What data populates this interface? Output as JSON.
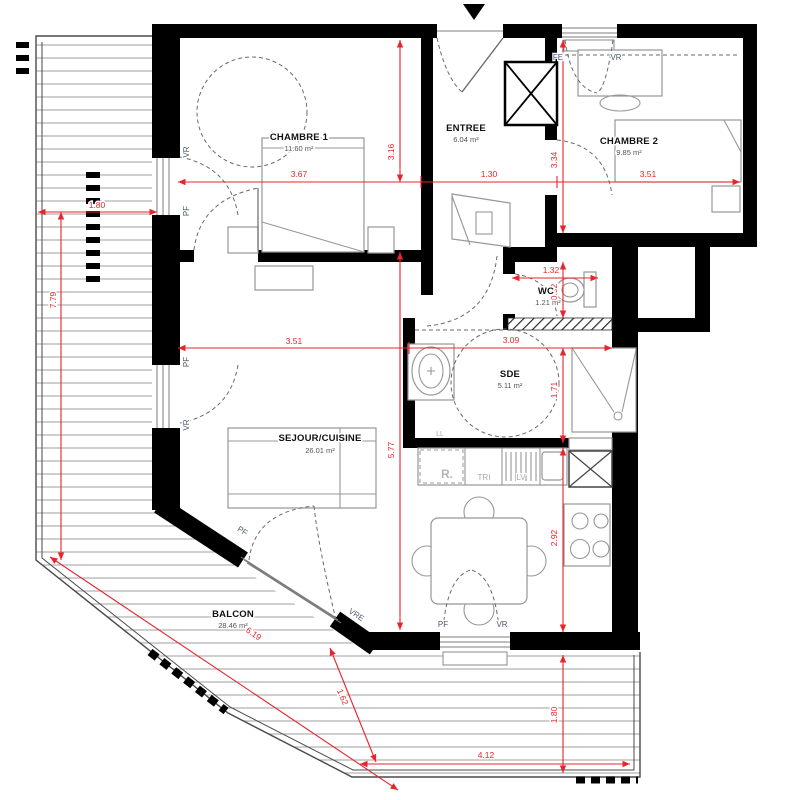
{
  "rooms": {
    "chambre1": {
      "name": "CHAMBRE 1",
      "area": "11.60 m²"
    },
    "entree": {
      "name": "ENTREE",
      "area": "6.04 m²"
    },
    "chambre2": {
      "name": "CHAMBRE 2",
      "area": "9.85 m²"
    },
    "wc": {
      "name": "WC",
      "area": "1.21 m²"
    },
    "sde": {
      "name": "SDE",
      "area": "5.11 m²"
    },
    "sejour": {
      "name": "SEJOUR/CUISINE",
      "area": "26.01 m²"
    },
    "balcon": {
      "name": "BALCON",
      "area": "28.46 m²"
    }
  },
  "dims": {
    "balcony_width": "1.80",
    "balcony_left_length": "7.79",
    "chambre1_width": "3.67",
    "entree_width": "1.30",
    "chambre2_width": "3.51",
    "chambre1_depth": "3.16",
    "chambre2_depth": "3.34",
    "wc_width": "1.32",
    "wc_depth": "0.92",
    "sejour_width": "3.51",
    "sde_width": "3.09",
    "sde_depth": "1.71",
    "sejour_depth": "5.77",
    "kitchen_depth": "2.92",
    "balcony_south_depth": "1.80",
    "balcony_south_width": "4.12",
    "balcony_edge_segment": "1.62",
    "balcony_diagonal": "6.19"
  },
  "openings": {
    "left_window_1_top": "VR",
    "left_window_1_bottom": "PF",
    "left_window_2_top": "PF",
    "left_window_2_bottom": "VR",
    "top_window_left": "FE",
    "top_window_right": "VR",
    "diagonal_window_upper": "PF",
    "diagonal_window_lower": "VRE",
    "bottom_window_left": "PF",
    "bottom_window_right": "VR"
  },
  "kitchen_labels": {
    "washing_machine": "LL",
    "fridge": "R.",
    "sorting": "TRI",
    "dishwasher": "LV"
  },
  "colors": {
    "wall": "#000000",
    "dimension": "#e8242c",
    "opening_label": "#4a5a6e",
    "room_name": "#111111",
    "room_area": "#555555",
    "furniture": "#979797"
  }
}
